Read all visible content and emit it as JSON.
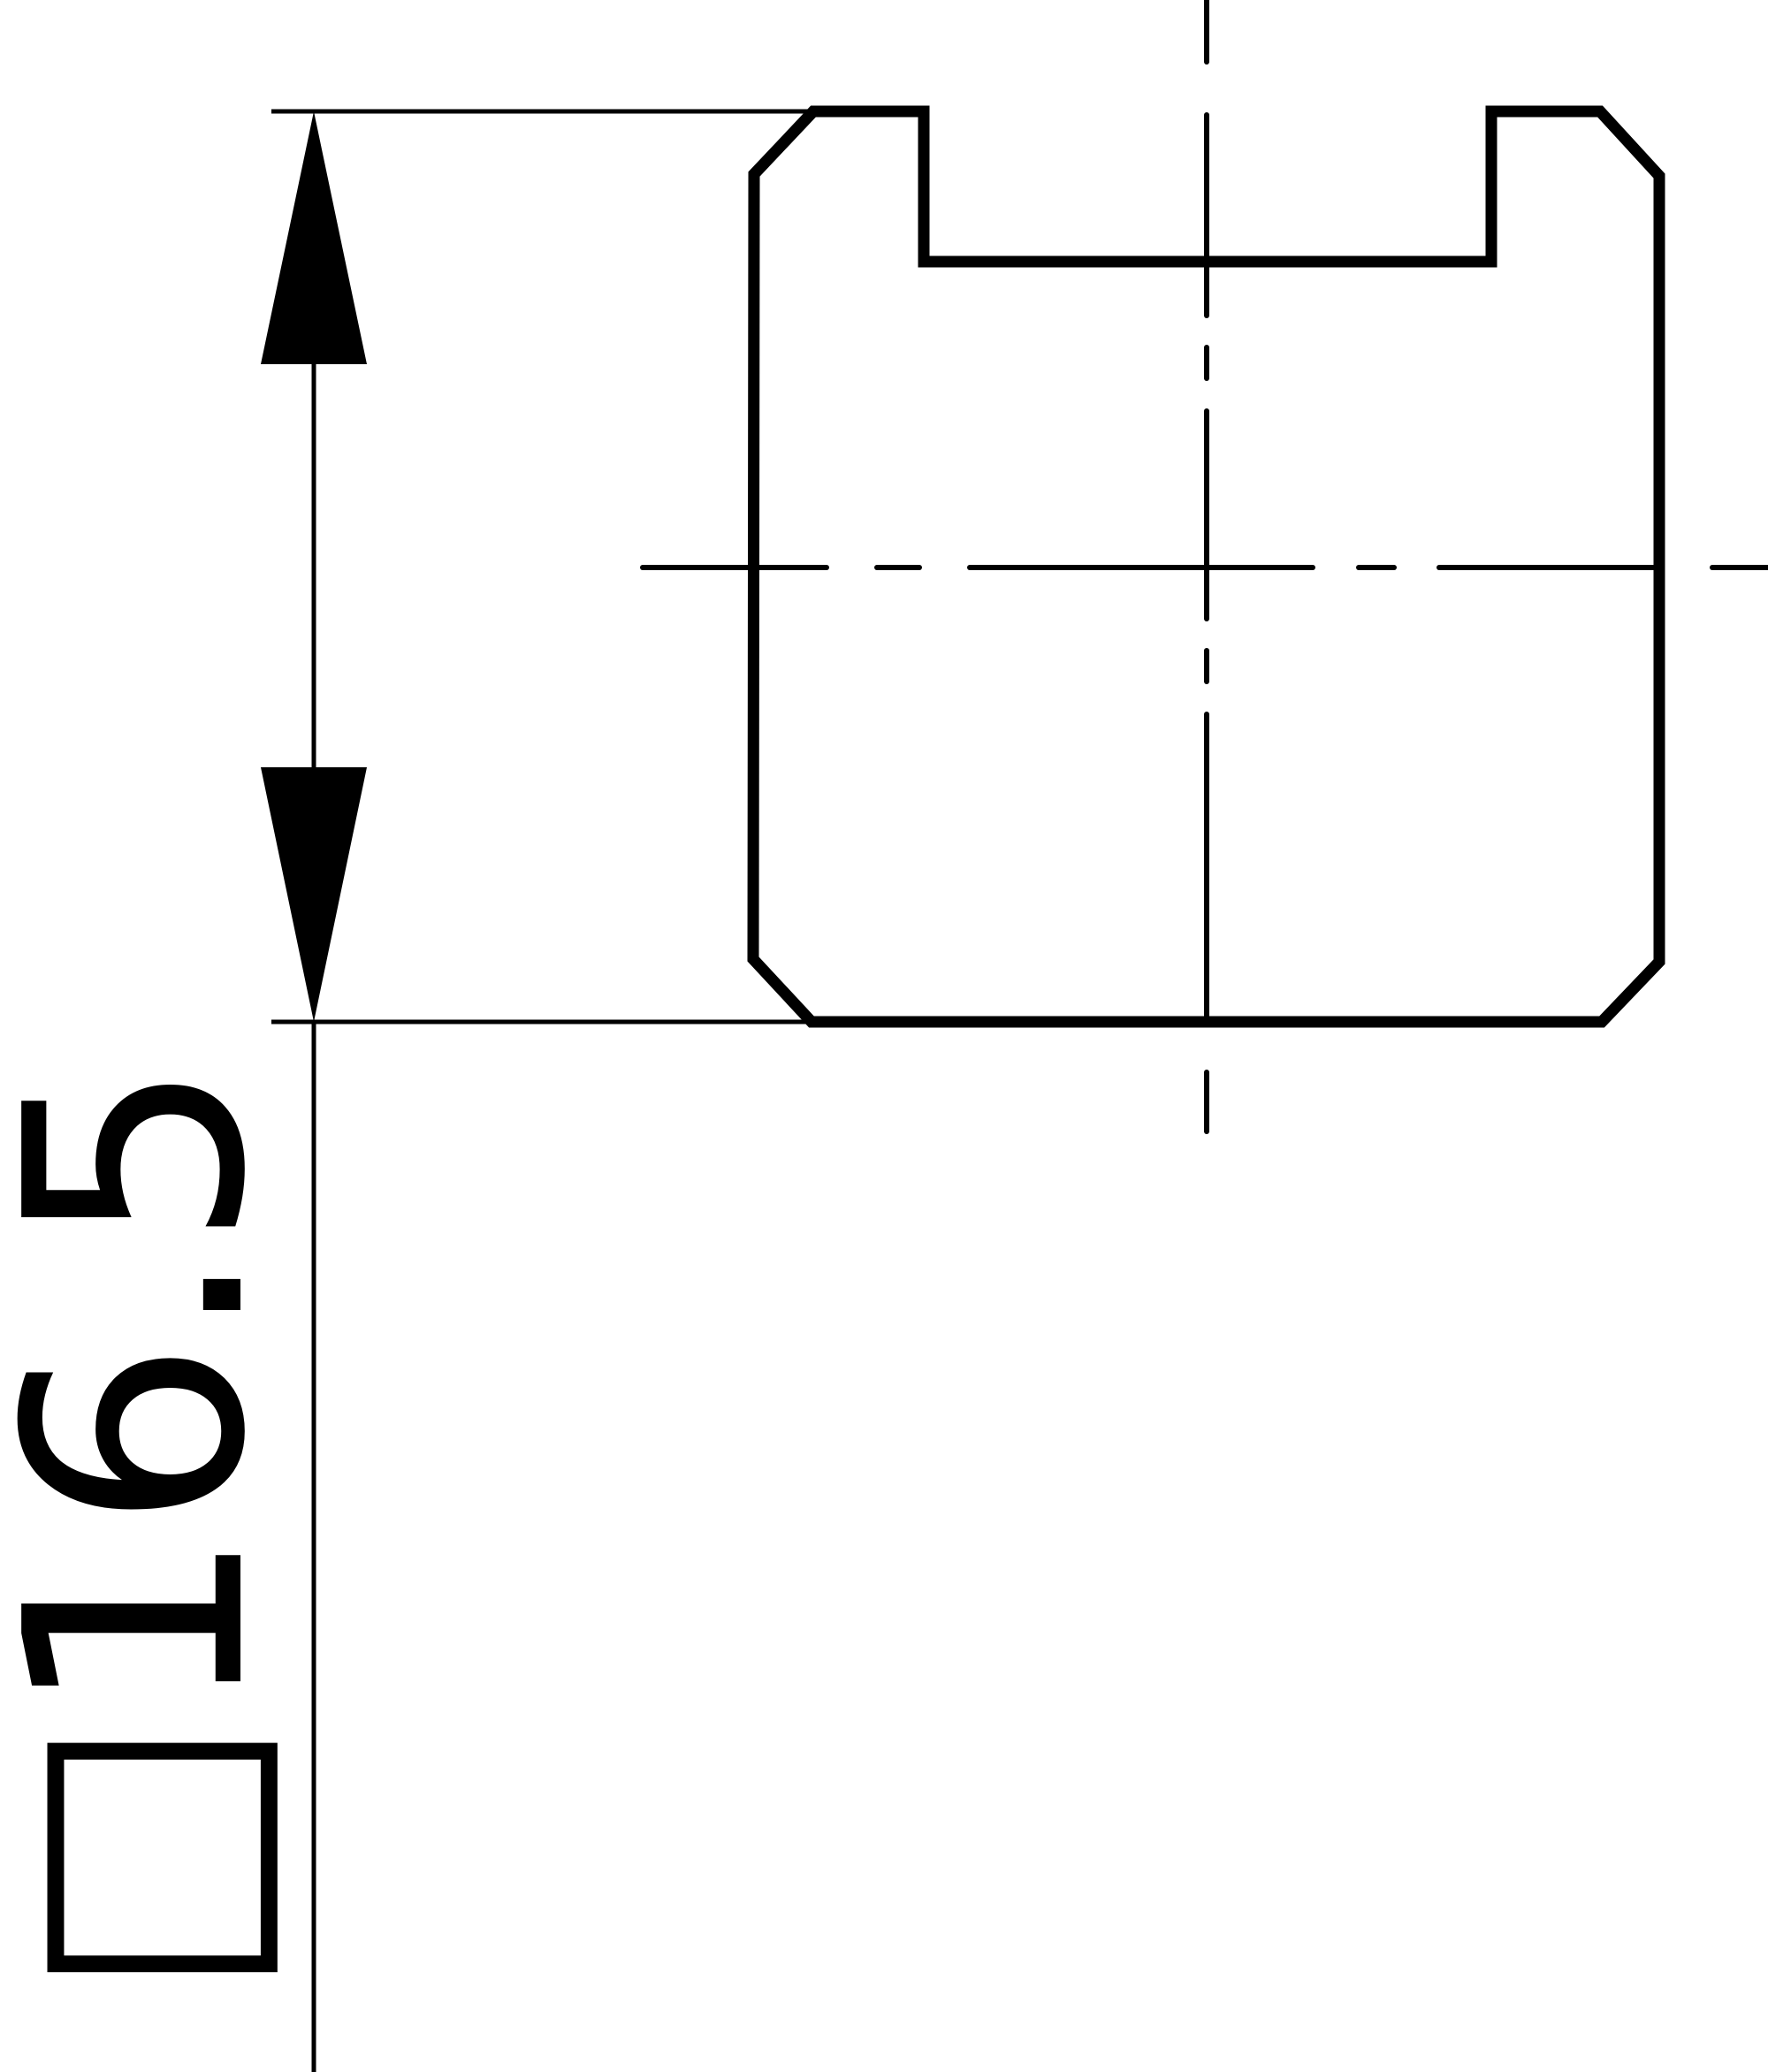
{
  "drawing": {
    "kind": "technical-drawing-cross-section",
    "dimension": {
      "symbol": "□",
      "value": "16.5",
      "label": "□16.5"
    },
    "colors": {
      "ink": "#000000",
      "background": "#ffffff"
    }
  }
}
